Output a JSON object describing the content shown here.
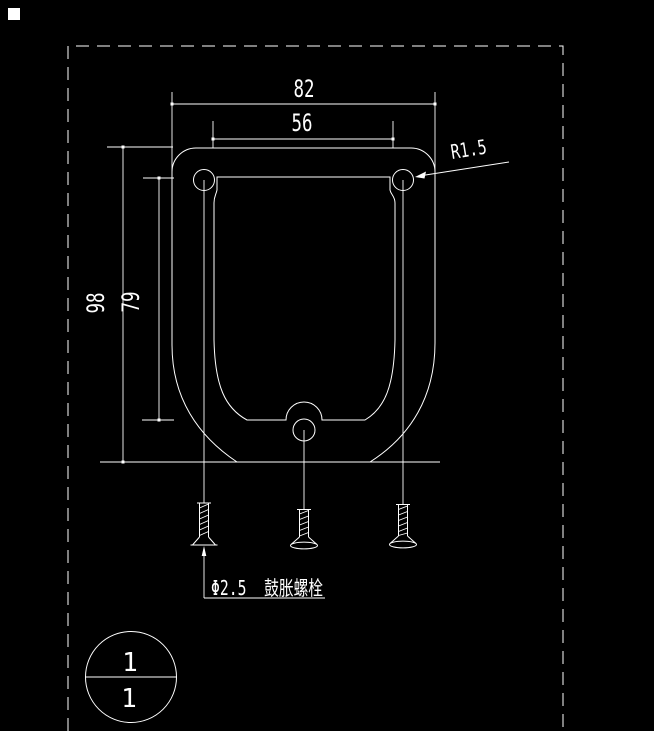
{
  "drawing": {
    "background_color": "#000000",
    "line_color": "#ffffff",
    "dimensions": {
      "top_outer": "82",
      "top_inner": "56",
      "left_outer": "98",
      "left_inner": "79",
      "radius_label": "R1.5"
    },
    "annotation": {
      "bolt_callout": "Φ2.5  鼓胀螺栓"
    },
    "detail_bubble": {
      "top": "1",
      "bottom": "1"
    }
  }
}
